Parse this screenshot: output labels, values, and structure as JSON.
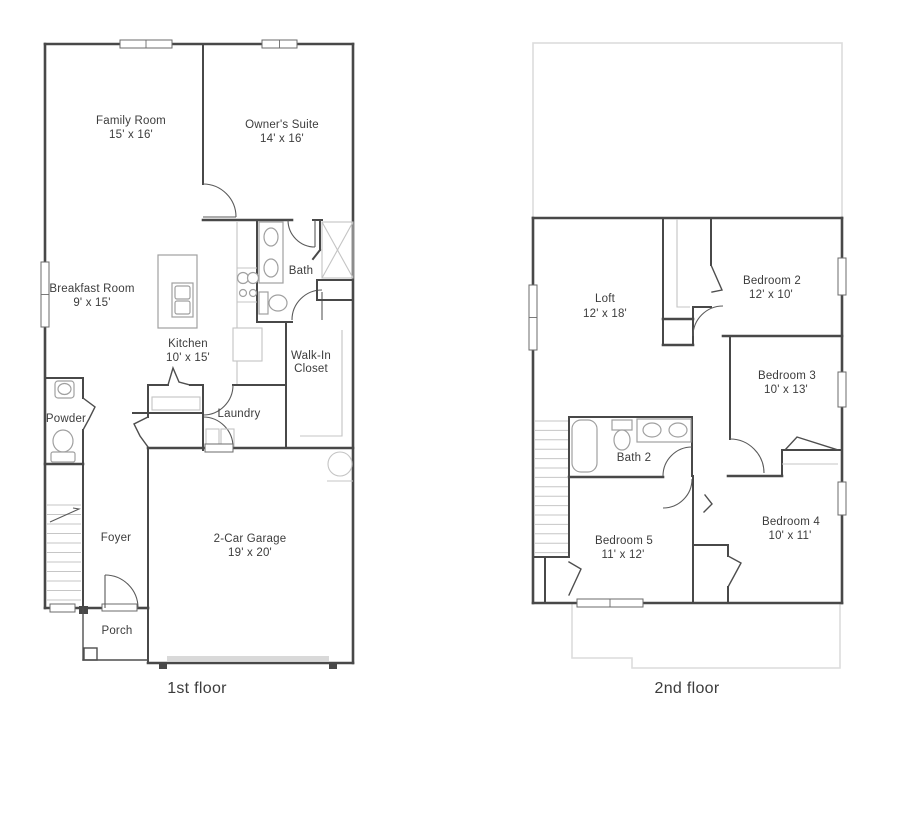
{
  "document": {
    "type": "floor-plan-sheet"
  },
  "colors": {
    "wall": "#484848",
    "fixture": "#a0a0a0",
    "roof_outline": "#dcdcdc",
    "text": "#3c3c3c",
    "background": "#ffffff"
  },
  "f1": {
    "caption": "1st floor",
    "rooms": {
      "family": {
        "name": "Family Room",
        "dims": "15' x 16'"
      },
      "owner": {
        "name": "Owner's Suite",
        "dims": "14' x 16'"
      },
      "breakfast": {
        "name": "Breakfast Room",
        "dims": "9' x 15'"
      },
      "kitchen": {
        "name": "Kitchen",
        "dims": "10' x 15'"
      },
      "bath": {
        "name": "Bath"
      },
      "walkin": {
        "name": "Walk-In Closet",
        "lines": [
          "Walk-In",
          "Closet"
        ]
      },
      "powder": {
        "name": "Powder"
      },
      "laundry": {
        "name": "Laundry"
      },
      "foyer": {
        "name": "Foyer"
      },
      "garage": {
        "name": "2-Car Garage",
        "dims": "19' x 20'"
      },
      "porch": {
        "name": "Porch"
      }
    }
  },
  "f2": {
    "caption": "2nd floor",
    "rooms": {
      "loft": {
        "name": "Loft",
        "dims": "12' x 18'"
      },
      "bed2": {
        "name": "Bedroom 2",
        "dims": "12' x 10'"
      },
      "bed3": {
        "name": "Bedroom 3",
        "dims": "10' x 13'"
      },
      "bath2": {
        "name": "Bath 2"
      },
      "bed4": {
        "name": "Bedroom 4",
        "dims": "10' x 11'"
      },
      "bed5": {
        "name": "Bedroom 5",
        "dims": "11' x 12'"
      }
    }
  }
}
